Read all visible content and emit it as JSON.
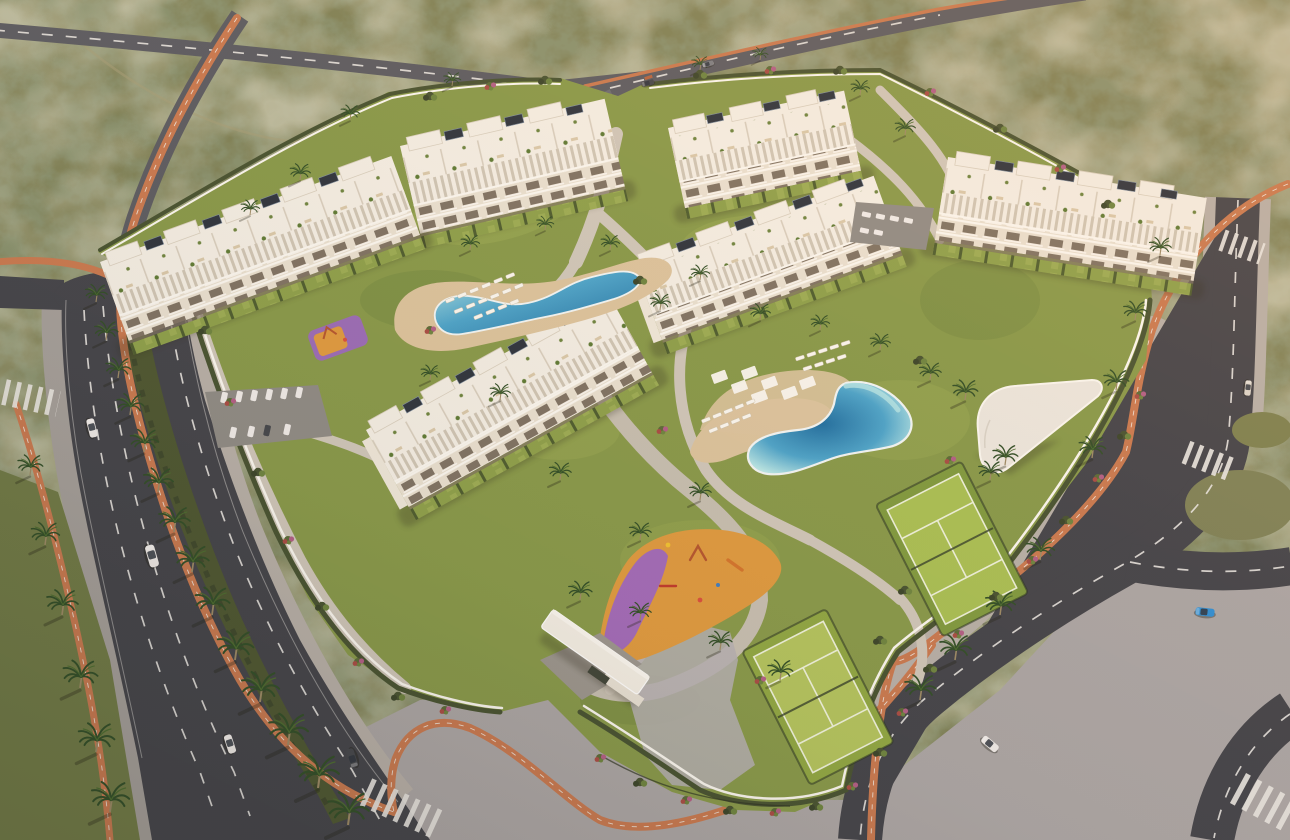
{
  "meta": {
    "title": "Aerial golden-hour render of a white Mediterranean apartment complex with lagoon pools, padel courts and palm-lined avenues set in coastal scrubland",
    "image_type": "architectural-visualization",
    "view": "high aerial three-quarter view",
    "lighting": "warm low sun, long shadows toward the south-west"
  },
  "palette": {
    "scrub": "#7e8157",
    "scrubDark": "#4d5434",
    "scrubDust": "#a59f78",
    "roadDark": "#42434a",
    "roadLight": "#5a5b62",
    "roadMid": "#4c4d54",
    "sidewalk": "#a49f9b",
    "plaza": "#aba6a6",
    "plazaWarm": "#b7b0a9",
    "bike": "#c97950",
    "bikeDash": "#f2efe9",
    "marking": "#e8e6e2",
    "median": "#4c5631",
    "hedge": "#465231",
    "hedgeDark": "#39442a",
    "lawn": "#87994a",
    "lawnBright": "#9cab54",
    "lawnDeep": "#6d8440",
    "path": "#cfc7bb",
    "pathWarm": "#c6bfb2",
    "deck": "#dcc49e",
    "poolLight": "#b5e6e8",
    "poolMid": "#4aa4cc",
    "poolDeep": "#1d6ea2",
    "white": "#f4efe6",
    "whiteBright": "#fbf8f2",
    "facadeBg": "#e9e1d2",
    "pergolaGap": "#cfc6b6",
    "window": "#6f6354",
    "endWall": "#efe8db",
    "solar": "#2c333e",
    "courtDark": "#7f9a3f",
    "courtLight": "#a9c054",
    "courtLine": "#eef2dc",
    "court2Dark": "#8fa743",
    "court2Light": "#b3c45e",
    "playOrange": "#df9a3f",
    "playPurple": "#9c66c4",
    "clubRoof": "#ece7df",
    "palm": "#2f4d27",
    "palmLight": "#4a6b2f",
    "trunk": "#9c8a66",
    "carWhite": "#f0ecea",
    "carDark": "#43464c",
    "carBlue": "#2e8fd6",
    "carGray": "#7b7e85",
    "carCream": "#dcd6cc",
    "shadow": "#2e2a1d"
  },
  "scene": {
    "environment": "dry olive-green coastal scrubland with pale dirt trails",
    "complex": {
      "buildings": {
        "count": 6,
        "storeys": 4,
        "style": "white apartment blocks with stacked balconies, rooftop pergola terraces, penthouses and solar panels",
        "private_gardens": "hedge-divided lawns at ground floor"
      },
      "boundary": "white perimeter wall with continuous dark hedge"
    },
    "amenities": [
      {
        "name": "lagoon pool",
        "loungers": 18,
        "shade_pergolas": 7
      },
      {
        "name": "upper pool",
        "loungers": 16
      },
      {
        "name": "padel-tennis court",
        "count": 2
      },
      {
        "name": "children playground",
        "surface_colors": [
          "orange",
          "purple"
        ]
      },
      {
        "name": "mini playground",
        "surface_colors": [
          "purple",
          "orange"
        ]
      },
      {
        "name": "pool clubhouse",
        "roof": "white"
      },
      {
        "name": "entrance canopy",
        "roof": "white"
      },
      {
        "name": "residents parking",
        "parked_cars": 12
      },
      {
        "name": "second parking court",
        "parked_cars": 6
      }
    ],
    "roads": [
      {
        "name": "west avenue",
        "lanes": 6,
        "features": [
          "hedge median",
          "palm rows",
          "terracotta cycle path",
          "zebra crossings"
        ]
      },
      {
        "name": "north road",
        "features": [
          "cycle lane",
          "crossroads with estate entry"
        ]
      },
      {
        "name": "east collector",
        "features": [
          "loop and branch",
          "cycle path",
          "zebra crossings"
        ]
      }
    ],
    "vehicles": [
      {
        "type": "car",
        "color": "white",
        "road": "west avenue"
      },
      {
        "type": "van",
        "color": "white",
        "road": "west avenue"
      },
      {
        "type": "car",
        "color": "white",
        "road": "west avenue south"
      },
      {
        "type": "car",
        "color": "dark grey",
        "road": "west avenue south"
      },
      {
        "type": "car",
        "color": "dark",
        "road": "north road"
      },
      {
        "type": "car",
        "color": "grey",
        "road": "north road"
      },
      {
        "type": "car",
        "color": "blue",
        "road": "east collector"
      },
      {
        "type": "car",
        "color": "white",
        "road": "east collector south"
      },
      {
        "type": "car",
        "color": "cream",
        "road": "east collector north"
      }
    ],
    "landscape": {
      "palms": "rows along every road and scattered through gardens",
      "shrubs": "green and magenta flowering clusters along walls"
    }
  }
}
